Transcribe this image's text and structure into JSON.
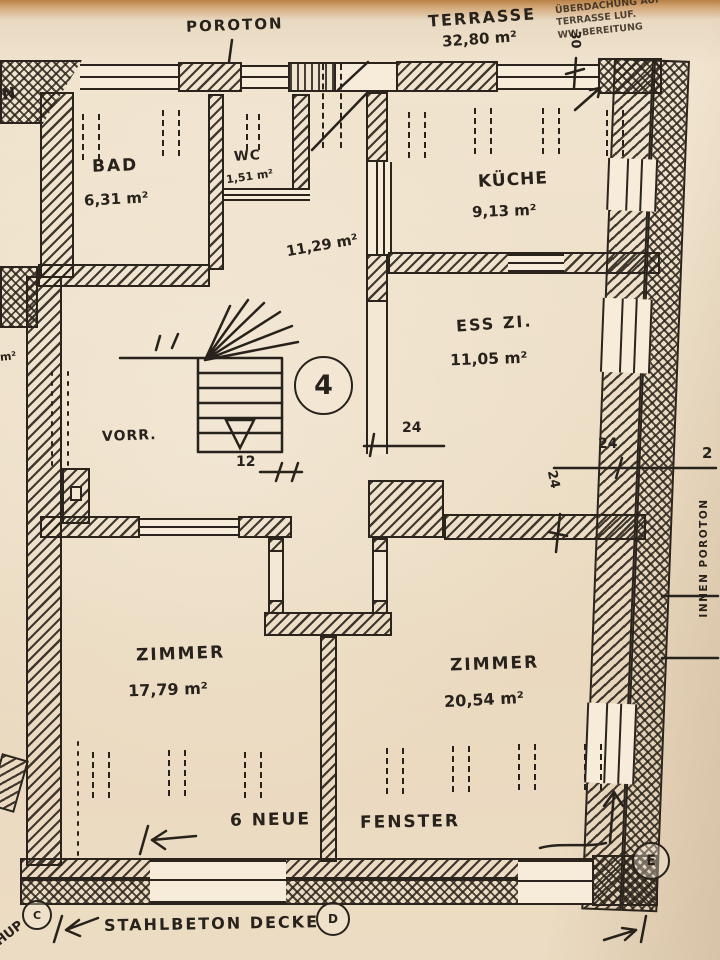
{
  "document": {
    "kind": "hand-drawn floor plan sketch, flat no. 4"
  },
  "top": {
    "poroton": "POROTON",
    "terrasse_title": "TERRASSE",
    "terrasse_area": "32,80 m²",
    "corner_note": {
      "line1": "ÜBERDACHUNG AUF",
      "line2": "TERRASSE LUF.",
      "line3": "WW-BEREITUNG"
    },
    "dim_30": "30",
    "edge_cut_text": "N"
  },
  "rooms": {
    "bad": {
      "name": "BAD",
      "area": "6,31 m²"
    },
    "wc": {
      "name": "WC",
      "area": "1,51 m²"
    },
    "kueche": {
      "name": "KÜCHE",
      "area": "9,13 m²"
    },
    "esszimmer": {
      "name": "ESS ZI.",
      "area": "11,05 m²"
    },
    "flur": {
      "area": "11,29 m²"
    },
    "vorraum": {
      "name": "VORR."
    },
    "zimmer_links": {
      "name": "ZIMMER",
      "area": "17,79 m²"
    },
    "zimmer_rechts": {
      "name": "ZIMMER",
      "area": "20,54 m²"
    }
  },
  "unit_circle": "4",
  "dimensions": {
    "d12": "12",
    "d24_flur": "24",
    "d24_wand": "24",
    "d24_aussen": "24",
    "d2_cut": "2"
  },
  "wall_note": "INNEN POROTON",
  "bottom": {
    "fenster_left": "6 NEUE",
    "fenster_right": "FENSTER",
    "decke": "STAHLBETON DECKE",
    "axis_c": "C",
    "axis_d": "D",
    "axis_e": "E",
    "corner_scribble": "HUP"
  },
  "left_edge": {
    "cut_area": "m²"
  }
}
